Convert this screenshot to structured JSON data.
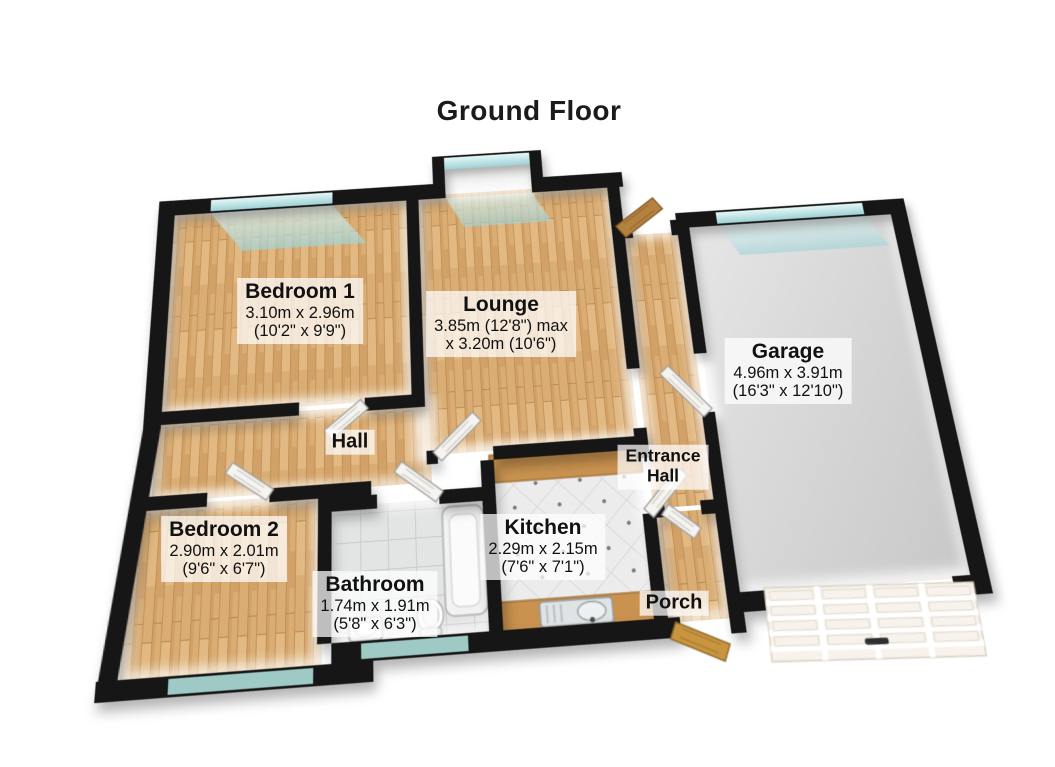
{
  "title": "Ground Floor",
  "rooms": {
    "bedroom1": {
      "name": "Bedroom 1",
      "metric": "3.10m x 2.96m",
      "imperial": "(10'2\" x 9'9\")"
    },
    "lounge": {
      "name": "Lounge",
      "metric": "3.85m (12'8\") max",
      "imperial": "x 3.20m (10'6\")"
    },
    "garage": {
      "name": "Garage",
      "metric": "4.96m x 3.91m",
      "imperial": "(16'3\" x 12'10\")"
    },
    "hall": {
      "name": "Hall"
    },
    "entrance_hall": {
      "name": "Entrance\nHall"
    },
    "bedroom2": {
      "name": "Bedroom 2",
      "metric": "2.90m x 2.01m",
      "imperial": "(9'6\" x 6'7\")"
    },
    "kitchen": {
      "name": "Kitchen",
      "metric": "2.29m x 2.15m",
      "imperial": "(7'6\" x 7'1\")"
    },
    "bathroom": {
      "name": "Bathroom",
      "metric": "1.74m x 1.91m",
      "imperial": "(5'8\" x 6'3\")"
    },
    "porch": {
      "name": "Porch"
    }
  },
  "palette": {
    "wall": "#161616",
    "wood_floor": "#d9ad74",
    "window_glass": "#bfe4e4",
    "bathroom_tile": "#e3e4e4",
    "kitchen_tile": "#ececec",
    "garage_floor": "#d6d6d6",
    "label_background": "rgba(255,255,255,0.72)"
  }
}
